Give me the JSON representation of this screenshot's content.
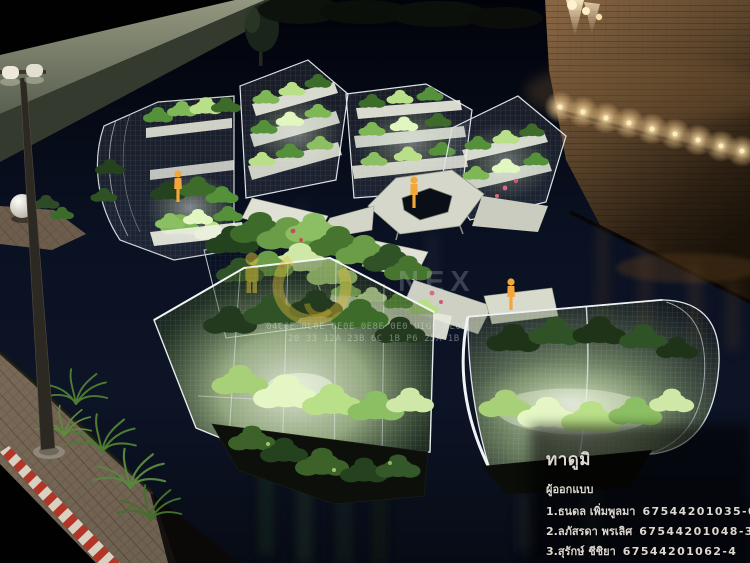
{
  "scene": {
    "setting": "night",
    "water_color": "#0a101f",
    "wall_light_color": "#f3ddad",
    "plant_glow_color": "#eaffd0",
    "figure_color": "#f2a63c",
    "figure_count": 3
  },
  "watermark": {
    "accent_color": "#e2c23c",
    "brand_text": "NEX",
    "tiny_line1": "04C8E 0L0E 0E0E 0E8E 0E0 UIGE 0E0E",
    "tiny_line2": "20 33 12A 23B 6C 1B P6 25A 1B"
  },
  "credits": {
    "title": "ทาดูมิ",
    "role_heading": "ผู้ออกแบบ",
    "designers": [
      {
        "label": "1.ธนดล เพิ่มพูลมา",
        "student_id": "67544201035-0"
      },
      {
        "label": "2.ลภัสรดา พรเลิศ",
        "student_id": "67544201048-3"
      },
      {
        "label": "3.สุรักษ์ ชีชิยา",
        "student_id": "67544201062-4"
      }
    ]
  }
}
